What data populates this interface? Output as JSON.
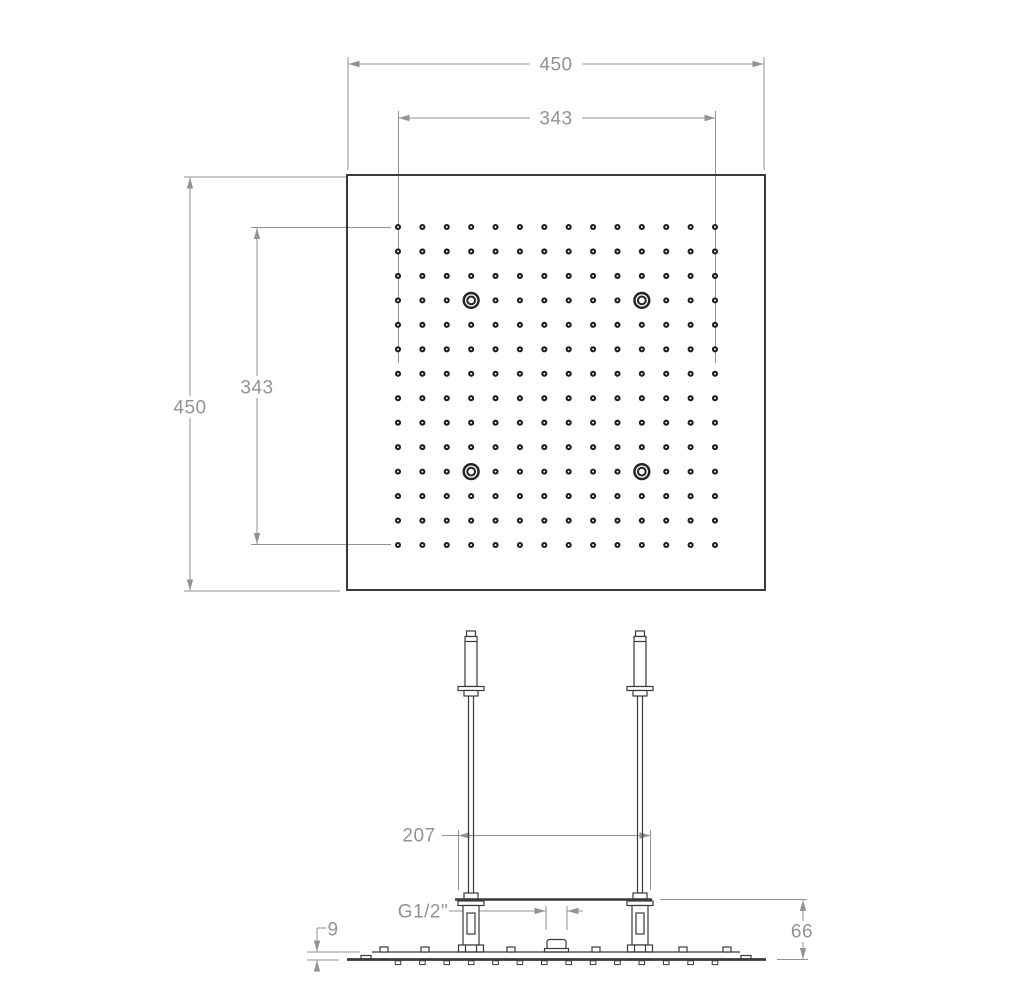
{
  "top_view": {
    "name": "ceiling shower head - plan view",
    "dimensions": {
      "overall_width": "450",
      "overall_height": "450",
      "nozzle_field_width": "343",
      "nozzle_field_height": "343"
    },
    "nozzle_grid": {
      "rows": 14,
      "cols": 14,
      "fitting_positions": [
        [
          3,
          3
        ],
        [
          3,
          10
        ],
        [
          10,
          3
        ],
        [
          10,
          10
        ]
      ]
    }
  },
  "side_view": {
    "name": "ceiling shower head - side elevation",
    "dimensions": {
      "pipe_spacing": "207",
      "inlet_thread": "G1/2\"",
      "plate_thickness": "9",
      "body_height": "66"
    }
  },
  "colors": {
    "part_line": "#3a3a3a",
    "dimension": "#939393",
    "background": "#ffffff"
  }
}
